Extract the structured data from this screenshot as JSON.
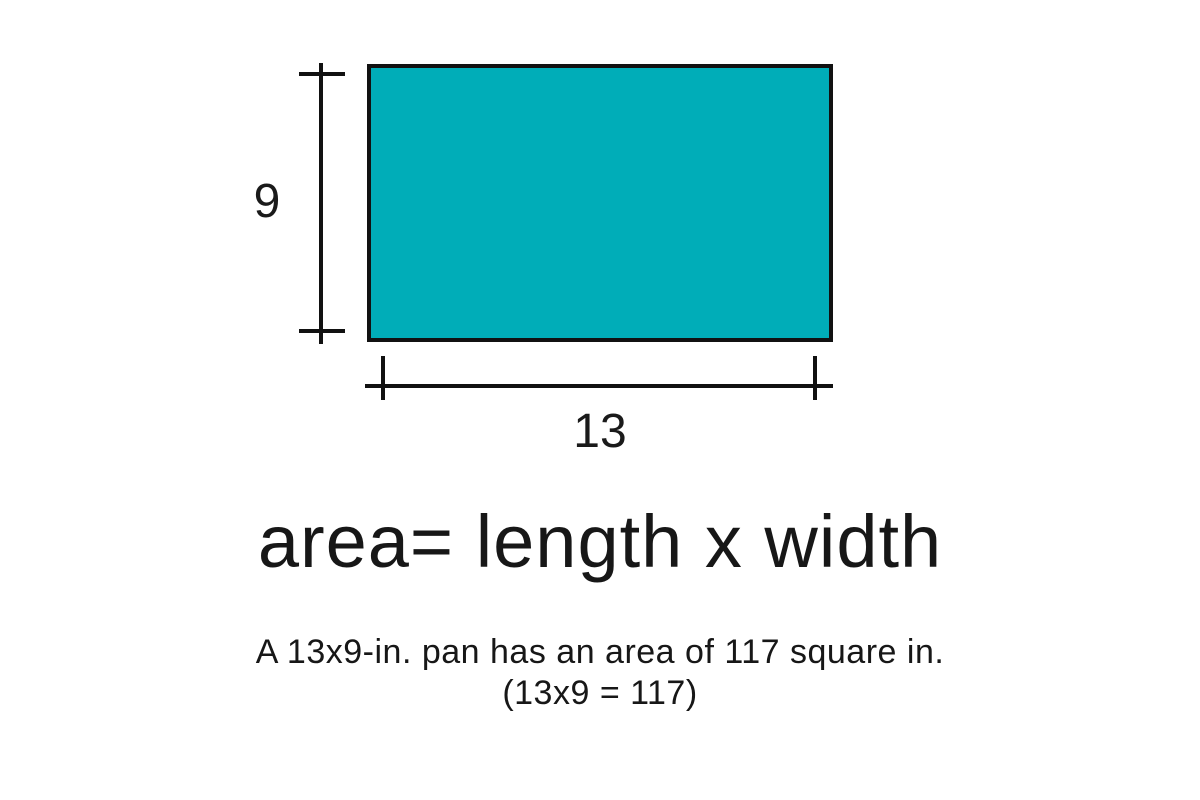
{
  "diagram": {
    "rect_fill_color": "#00ADB8",
    "line_color": "#111111",
    "height_label": "9",
    "width_label": "13"
  },
  "formula_text": "area= length x width",
  "caption": {
    "line1": "A 13x9-in. pan has an area of 117 square in.",
    "line2": "(13x9 = 117)"
  }
}
